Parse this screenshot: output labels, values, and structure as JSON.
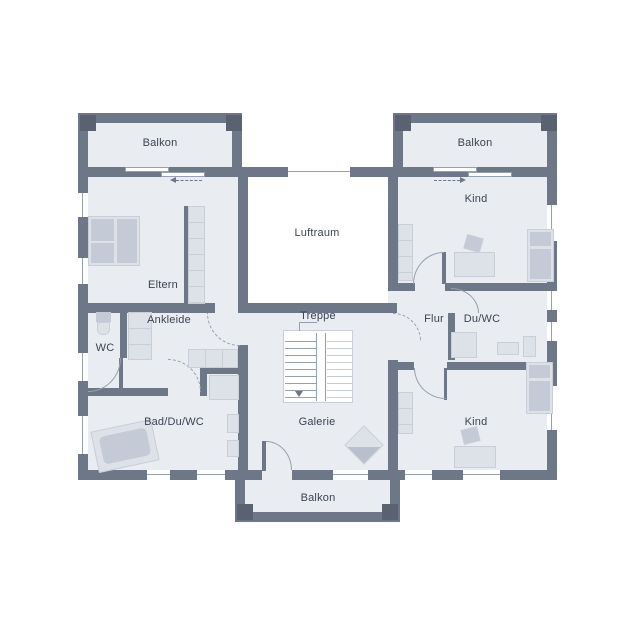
{
  "rooms": [
    {
      "name": "balkon-top-left",
      "label": "Balkon"
    },
    {
      "name": "balkon-top-right",
      "label": "Balkon"
    },
    {
      "name": "eltern",
      "label": "Eltern"
    },
    {
      "name": "luftraum",
      "label": "Luftraum"
    },
    {
      "name": "kind-top",
      "label": "Kind"
    },
    {
      "name": "ankleide",
      "label": "Ankleide"
    },
    {
      "name": "wc",
      "label": "WC"
    },
    {
      "name": "treppe",
      "label": "Treppe"
    },
    {
      "name": "flur",
      "label": "Flur"
    },
    {
      "name": "du-wc",
      "label": "Du/WC"
    },
    {
      "name": "bad-du-wc",
      "label": "Bad/Du/WC"
    },
    {
      "name": "galerie",
      "label": "Galerie"
    },
    {
      "name": "kind-bottom",
      "label": "Kind"
    },
    {
      "name": "balkon-bottom",
      "label": "Balkon"
    }
  ],
  "colors": {
    "wall": "#6e7788",
    "wall_dark": "#5a6272",
    "floor": "#e9ecf1",
    "void": "#ffffff",
    "furniture": "#dde1e8",
    "furniture_dark": "#c5cbd6",
    "furniture_border": "#c9ced8",
    "line": "#97a0ae",
    "text": "#3c4352"
  }
}
